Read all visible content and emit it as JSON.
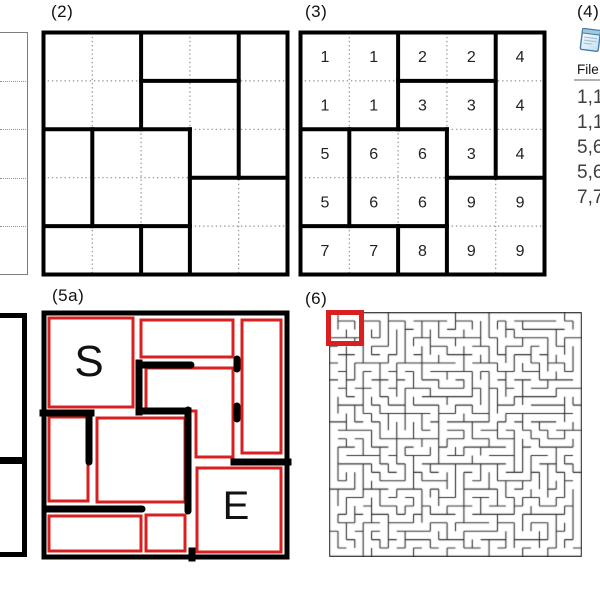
{
  "colors": {
    "red": "#d91f1f",
    "bold_line": "#000000",
    "dotted_line": "#929292",
    "maze_line": "#303030",
    "thin_gray_border": "#7d7d7d"
  },
  "panel2": {
    "label": "(2)",
    "grid_rows": 5,
    "grid_cols": 5,
    "bold_h": [
      [
        1,
        2,
        4
      ],
      [
        2,
        0,
        3
      ],
      [
        3,
        3,
        5
      ],
      [
        4,
        0,
        3
      ]
    ],
    "bold_v": [
      [
        2,
        0,
        2
      ],
      [
        4,
        0,
        3
      ],
      [
        1,
        2,
        4
      ],
      [
        3,
        2,
        5
      ],
      [
        2,
        4,
        5
      ]
    ]
  },
  "panel3": {
    "label": "(3)",
    "grid_rows": 5,
    "grid_cols": 5,
    "cells": [
      [
        1,
        1,
        2,
        2,
        4
      ],
      [
        1,
        1,
        3,
        3,
        4
      ],
      [
        5,
        6,
        6,
        3,
        4
      ],
      [
        5,
        6,
        6,
        9,
        9
      ],
      [
        7,
        7,
        8,
        9,
        9
      ]
    ],
    "bold_h": [
      [
        1,
        2,
        4
      ],
      [
        2,
        0,
        3
      ],
      [
        3,
        3,
        5
      ],
      [
        4,
        0,
        3
      ]
    ],
    "bold_v": [
      [
        2,
        0,
        2
      ],
      [
        4,
        0,
        3
      ],
      [
        1,
        2,
        4
      ],
      [
        3,
        2,
        5
      ],
      [
        2,
        4,
        5
      ]
    ]
  },
  "panel4": {
    "label": "(4)",
    "icon": "notepad-icon",
    "menu": "File",
    "lines": [
      "1,1",
      "1,1",
      "5,6",
      "5,6",
      "7,7"
    ]
  },
  "panel5a": {
    "label": "(5a)",
    "start": "S",
    "end": "E",
    "red_rects": [
      [
        5,
        5,
        84,
        89
      ],
      [
        97,
        7,
        92,
        37
      ],
      [
        198,
        7,
        39,
        133
      ],
      [
        5,
        104,
        39,
        84
      ],
      [
        53,
        105,
        88,
        84
      ],
      [
        153,
        155,
        84,
        84
      ],
      [
        5,
        203,
        92,
        35
      ],
      [
        102,
        202,
        39,
        36
      ]
    ],
    "red_polygon": [
      [
        102,
        55
      ],
      [
        189,
        55
      ],
      [
        189,
        144
      ],
      [
        152,
        144
      ],
      [
        152,
        98
      ],
      [
        102,
        98
      ]
    ],
    "bars_round": [
      [
        95,
        52,
        147,
        52
      ],
      [
        193,
        46,
        193,
        56
      ],
      [
        193,
        93,
        193,
        106
      ],
      [
        144,
        97,
        144,
        198
      ],
      [
        45,
        101,
        45,
        149
      ],
      [
        1,
        196,
        98,
        196
      ]
    ],
    "bars_flat": [
      [
        95,
        50,
        95,
        99
      ],
      [
        95,
        98,
        144,
        98
      ],
      [
        190,
        149,
        244,
        149
      ],
      [
        -1,
        100,
        47,
        100
      ],
      [
        148,
        238,
        148,
        245
      ]
    ],
    "start_pos": [
      45,
      63,
      44
    ],
    "end_pos": [
      192,
      206,
      40
    ]
  },
  "panel6": {
    "label": "(6)",
    "maze_cols": 30,
    "maze_rows": 29,
    "maze_seed": 421,
    "red_box": [
      326,
      310,
      38,
      36
    ]
  }
}
